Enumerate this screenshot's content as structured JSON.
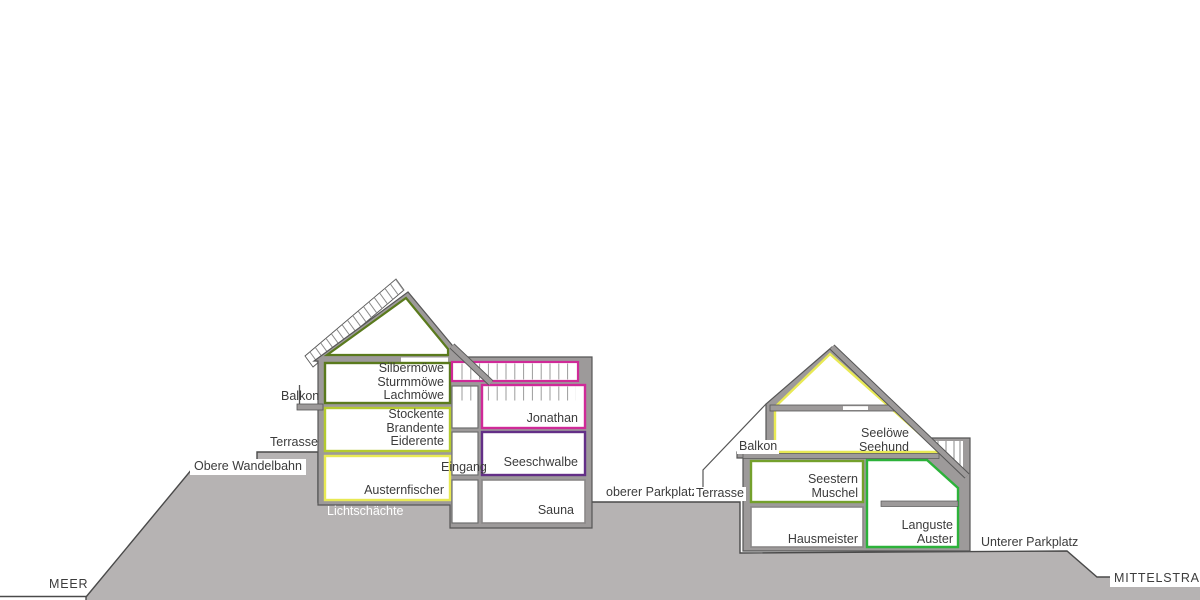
{
  "site_labels": {
    "meer": "MEER",
    "mittelstrasse": "MITTELSTRASSE",
    "obere_wandelbahn": "Obere Wandelbahn",
    "lichtschaechte": "Lichtschächte",
    "oberer_parkplatz": "oberer Parkplatz",
    "unterer_parkplatz": "Unterer Parkplatz",
    "eingang": "Eingang",
    "balkon_left": "Balkon",
    "terrasse_left": "Terrasse",
    "balkon_right": "Balkon",
    "terrasse_right": "Terrasse"
  },
  "rooms": {
    "silbermoewe": [
      "Silbermöwe",
      "Sturmmöwe",
      "Lachmöwe"
    ],
    "stockente": [
      "Stockente",
      "Brandente",
      "Eiderente"
    ],
    "austernfischer": [
      "Austernfischer"
    ],
    "jonathan": [
      "Jonathan"
    ],
    "seeschwalbe": [
      "Seeschwalbe"
    ],
    "sauna": [
      "Sauna"
    ],
    "seeloewe": [
      "Seelöwe",
      "Seehund"
    ],
    "seestern": [
      "Seestern",
      "Muschel"
    ],
    "hausmeister": [
      "Hausmeister"
    ],
    "languste": [
      "Languste",
      "Auster"
    ]
  },
  "colors": {
    "wall": "#9d9a9a",
    "wall_edge": "#565656",
    "terrain": "#b6b3b3",
    "line": "#4a4a4a",
    "text": "#3c3c3c",
    "dark_green": "#5a7a1d",
    "yellow_green": "#b4ca30",
    "yellow": "#e8e954",
    "magenta": "#cf2a98",
    "purple": "#632f87",
    "bright_green": "#2cb23a",
    "olive_green": "#74a02c",
    "gray_room": "#8a8888",
    "hatch": "#9a9a9a"
  }
}
